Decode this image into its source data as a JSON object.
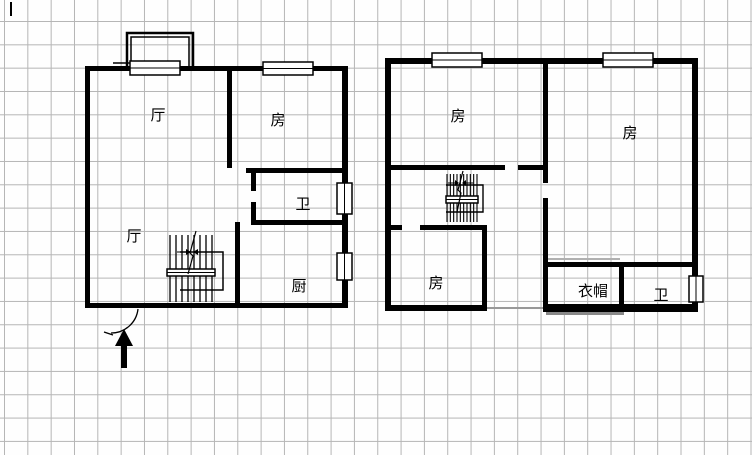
{
  "canvas": {
    "width": 752,
    "height": 455,
    "background": "#fefefe",
    "grid_color": "#b5b5b5",
    "grid_size": 23.33,
    "ink_color": "#000000"
  },
  "caret_mark": {
    "x": 10,
    "y": 2,
    "w": 2,
    "h": 14
  },
  "floorplan_data": {
    "type": "floorplan",
    "plans": [
      {
        "id": "floor-1",
        "labels": [
          {
            "text": "厅",
            "x": 158,
            "y": 120
          },
          {
            "text": "房",
            "x": 278,
            "y": 125
          },
          {
            "text": "卫",
            "x": 303,
            "y": 209
          },
          {
            "text": "厅",
            "x": 134,
            "y": 241
          },
          {
            "text": "厨",
            "x": 299,
            "y": 291
          }
        ],
        "shapes": [
          {
            "t": "rect",
            "x": 85,
            "y": 66,
            "w": 263,
            "h": 5
          },
          {
            "t": "rect",
            "x": 85,
            "y": 66,
            "w": 5,
            "h": 242
          },
          {
            "t": "rect",
            "x": 85,
            "y": 303,
            "w": 260,
            "h": 5
          },
          {
            "t": "rect",
            "x": 342,
            "y": 66,
            "w": 6,
            "h": 242
          },
          {
            "t": "rect",
            "x": 227,
            "y": 71,
            "w": 5,
            "h": 97
          },
          {
            "t": "rect",
            "x": 246,
            "y": 168,
            "w": 102,
            "h": 5
          },
          {
            "t": "rect",
            "x": 251,
            "y": 173,
            "w": 5,
            "h": 18
          },
          {
            "t": "rect",
            "x": 251,
            "y": 202,
            "w": 5,
            "h": 23
          },
          {
            "t": "rect",
            "x": 251,
            "y": 220,
            "w": 97,
            "h": 5
          },
          {
            "t": "rect",
            "x": 235,
            "y": 222,
            "w": 5,
            "h": 86
          },
          {
            "t": "poly",
            "pts": [
              [
                127,
                70
              ],
              [
                127,
                33
              ],
              [
                193,
                33
              ],
              [
                193,
                70
              ]
            ],
            "sw": 2.5
          },
          {
            "t": "poly",
            "pts": [
              [
                131,
                70
              ],
              [
                131,
                37
              ],
              [
                189,
                37
              ],
              [
                189,
                70
              ]
            ],
            "sw": 1.5
          },
          {
            "t": "line",
            "x1": 113,
            "y1": 63,
            "x2": 130,
            "y2": 63,
            "sw": 1.5
          },
          {
            "t": "win",
            "x": 130,
            "y": 61,
            "w": 50,
            "h": 14
          },
          {
            "t": "win",
            "x": 263,
            "y": 62,
            "w": 50,
            "h": 13
          },
          {
            "t": "win",
            "x": 337,
            "y": 183,
            "w": 15,
            "h": 31
          },
          {
            "t": "win",
            "x": 337,
            "y": 253,
            "w": 15,
            "h": 27
          },
          {
            "t": "treads",
            "x1": 170,
            "x2": 212,
            "n": 8,
            "y1": 235,
            "y2": 302,
            "sw": 1.3
          },
          {
            "t": "win",
            "x": 167,
            "y": 269,
            "w": 48,
            "h": 7
          },
          {
            "t": "poly",
            "pts": [
              [
                180,
                252
              ],
              [
                223,
                252
              ],
              [
                223,
                290
              ],
              [
                180,
                290
              ]
            ],
            "sw": 1.5
          },
          {
            "t": "poly",
            "pts": [
              [
                196,
                231
              ],
              [
                190,
                253
              ],
              [
                193,
                256
              ],
              [
                188,
                274
              ]
            ],
            "sw": 1.2
          },
          {
            "t": "line",
            "x1": 177,
            "y1": 252,
            "x2": 186,
            "y2": 252,
            "sw": 1
          },
          {
            "t": "tri",
            "pts": [
              [
                186,
                249
              ],
              [
                186,
                255
              ],
              [
                191,
                252
              ]
            ]
          },
          {
            "t": "line",
            "x1": 207,
            "y1": 252,
            "x2": 198,
            "y2": 252,
            "sw": 1
          },
          {
            "t": "tri",
            "pts": [
              [
                198,
                249
              ],
              [
                198,
                255
              ],
              [
                193,
                252
              ]
            ]
          },
          {
            "t": "path",
            "d": "M 138 309 A 27 27 0 0 1 111 333",
            "sw": 1.3
          },
          {
            "t": "line",
            "x1": 104,
            "y1": 332,
            "x2": 113,
            "y2": 335,
            "sw": 1.3
          },
          {
            "t": "rect",
            "x": 121,
            "y": 346,
            "w": 6,
            "h": 22
          },
          {
            "t": "tri",
            "pts": [
              [
                115,
                346
              ],
              [
                133,
                346
              ],
              [
                124,
                329
              ]
            ]
          }
        ]
      },
      {
        "id": "floor-2",
        "labels": [
          {
            "text": "房",
            "x": 458,
            "y": 121
          },
          {
            "text": "房",
            "x": 630,
            "y": 138
          },
          {
            "text": "房",
            "x": 436,
            "y": 288
          },
          {
            "text": "衣帽",
            "x": 593,
            "y": 296
          },
          {
            "text": "卫",
            "x": 661,
            "y": 300
          }
        ],
        "shapes": [
          {
            "t": "rect",
            "x": 385,
            "y": 58,
            "w": 313,
            "h": 6
          },
          {
            "t": "rect",
            "x": 385,
            "y": 58,
            "w": 6,
            "h": 253
          },
          {
            "t": "rect",
            "x": 692,
            "y": 58,
            "w": 6,
            "h": 253
          },
          {
            "t": "rect",
            "x": 385,
            "y": 305,
            "w": 102,
            "h": 6
          },
          {
            "t": "rect",
            "x": 487,
            "y": 307,
            "w": 58,
            "h": 2,
            "f": "#999999"
          },
          {
            "t": "rect",
            "x": 543,
            "y": 304,
            "w": 155,
            "h": 8
          },
          {
            "t": "rect",
            "x": 543,
            "y": 64,
            "w": 5,
            "h": 119
          },
          {
            "t": "rect",
            "x": 543,
            "y": 198,
            "w": 5,
            "h": 107
          },
          {
            "t": "rect",
            "x": 390,
            "y": 165,
            "w": 115,
            "h": 5
          },
          {
            "t": "rect",
            "x": 518,
            "y": 165,
            "w": 25,
            "h": 5
          },
          {
            "t": "rect",
            "x": 390,
            "y": 225,
            "w": 12,
            "h": 5
          },
          {
            "t": "rect",
            "x": 420,
            "y": 225,
            "w": 67,
            "h": 5
          },
          {
            "t": "rect",
            "x": 482,
            "y": 225,
            "w": 5,
            "h": 80
          },
          {
            "t": "rect",
            "x": 548,
            "y": 258,
            "w": 72,
            "h": 2,
            "f": "#b0b0b0"
          },
          {
            "t": "rect",
            "x": 546,
            "y": 262,
            "w": 146,
            "h": 5
          },
          {
            "t": "rect",
            "x": 619,
            "y": 262,
            "w": 5,
            "h": 43
          },
          {
            "t": "rect",
            "x": 546,
            "y": 312,
            "w": 78,
            "h": 3,
            "f": "#888888"
          },
          {
            "t": "win",
            "x": 432,
            "y": 53,
            "w": 50,
            "h": 14
          },
          {
            "t": "win",
            "x": 603,
            "y": 53,
            "w": 50,
            "h": 14
          },
          {
            "t": "win",
            "x": 689,
            "y": 276,
            "w": 14,
            "h": 26
          },
          {
            "t": "treads",
            "x1": 447,
            "x2": 477,
            "n": 10,
            "y1": 174,
            "y2": 222,
            "sw": 1.1
          },
          {
            "t": "win",
            "x": 446,
            "y": 196,
            "w": 32,
            "h": 7
          },
          {
            "t": "poly",
            "pts": [
              [
                446,
                185
              ],
              [
                483,
                185
              ],
              [
                483,
                212
              ],
              [
                446,
                212
              ]
            ],
            "sw": 1.4
          },
          {
            "t": "poly",
            "pts": [
              [
                463,
                171
              ],
              [
                458,
                190
              ],
              [
                461,
                193
              ],
              [
                457,
                212
              ]
            ],
            "sw": 1.2
          },
          {
            "t": "line",
            "x1": 448,
            "y1": 183,
            "x2": 455,
            "y2": 183,
            "sw": 1
          },
          {
            "t": "tri",
            "pts": [
              [
                455,
                180
              ],
              [
                455,
                186
              ],
              [
                459,
                183
              ]
            ]
          },
          {
            "t": "line",
            "x1": 473,
            "y1": 183,
            "x2": 466,
            "y2": 183,
            "sw": 1
          },
          {
            "t": "tri",
            "pts": [
              [
                466,
                180
              ],
              [
                466,
                186
              ],
              [
                462,
                183
              ]
            ]
          }
        ]
      }
    ]
  }
}
